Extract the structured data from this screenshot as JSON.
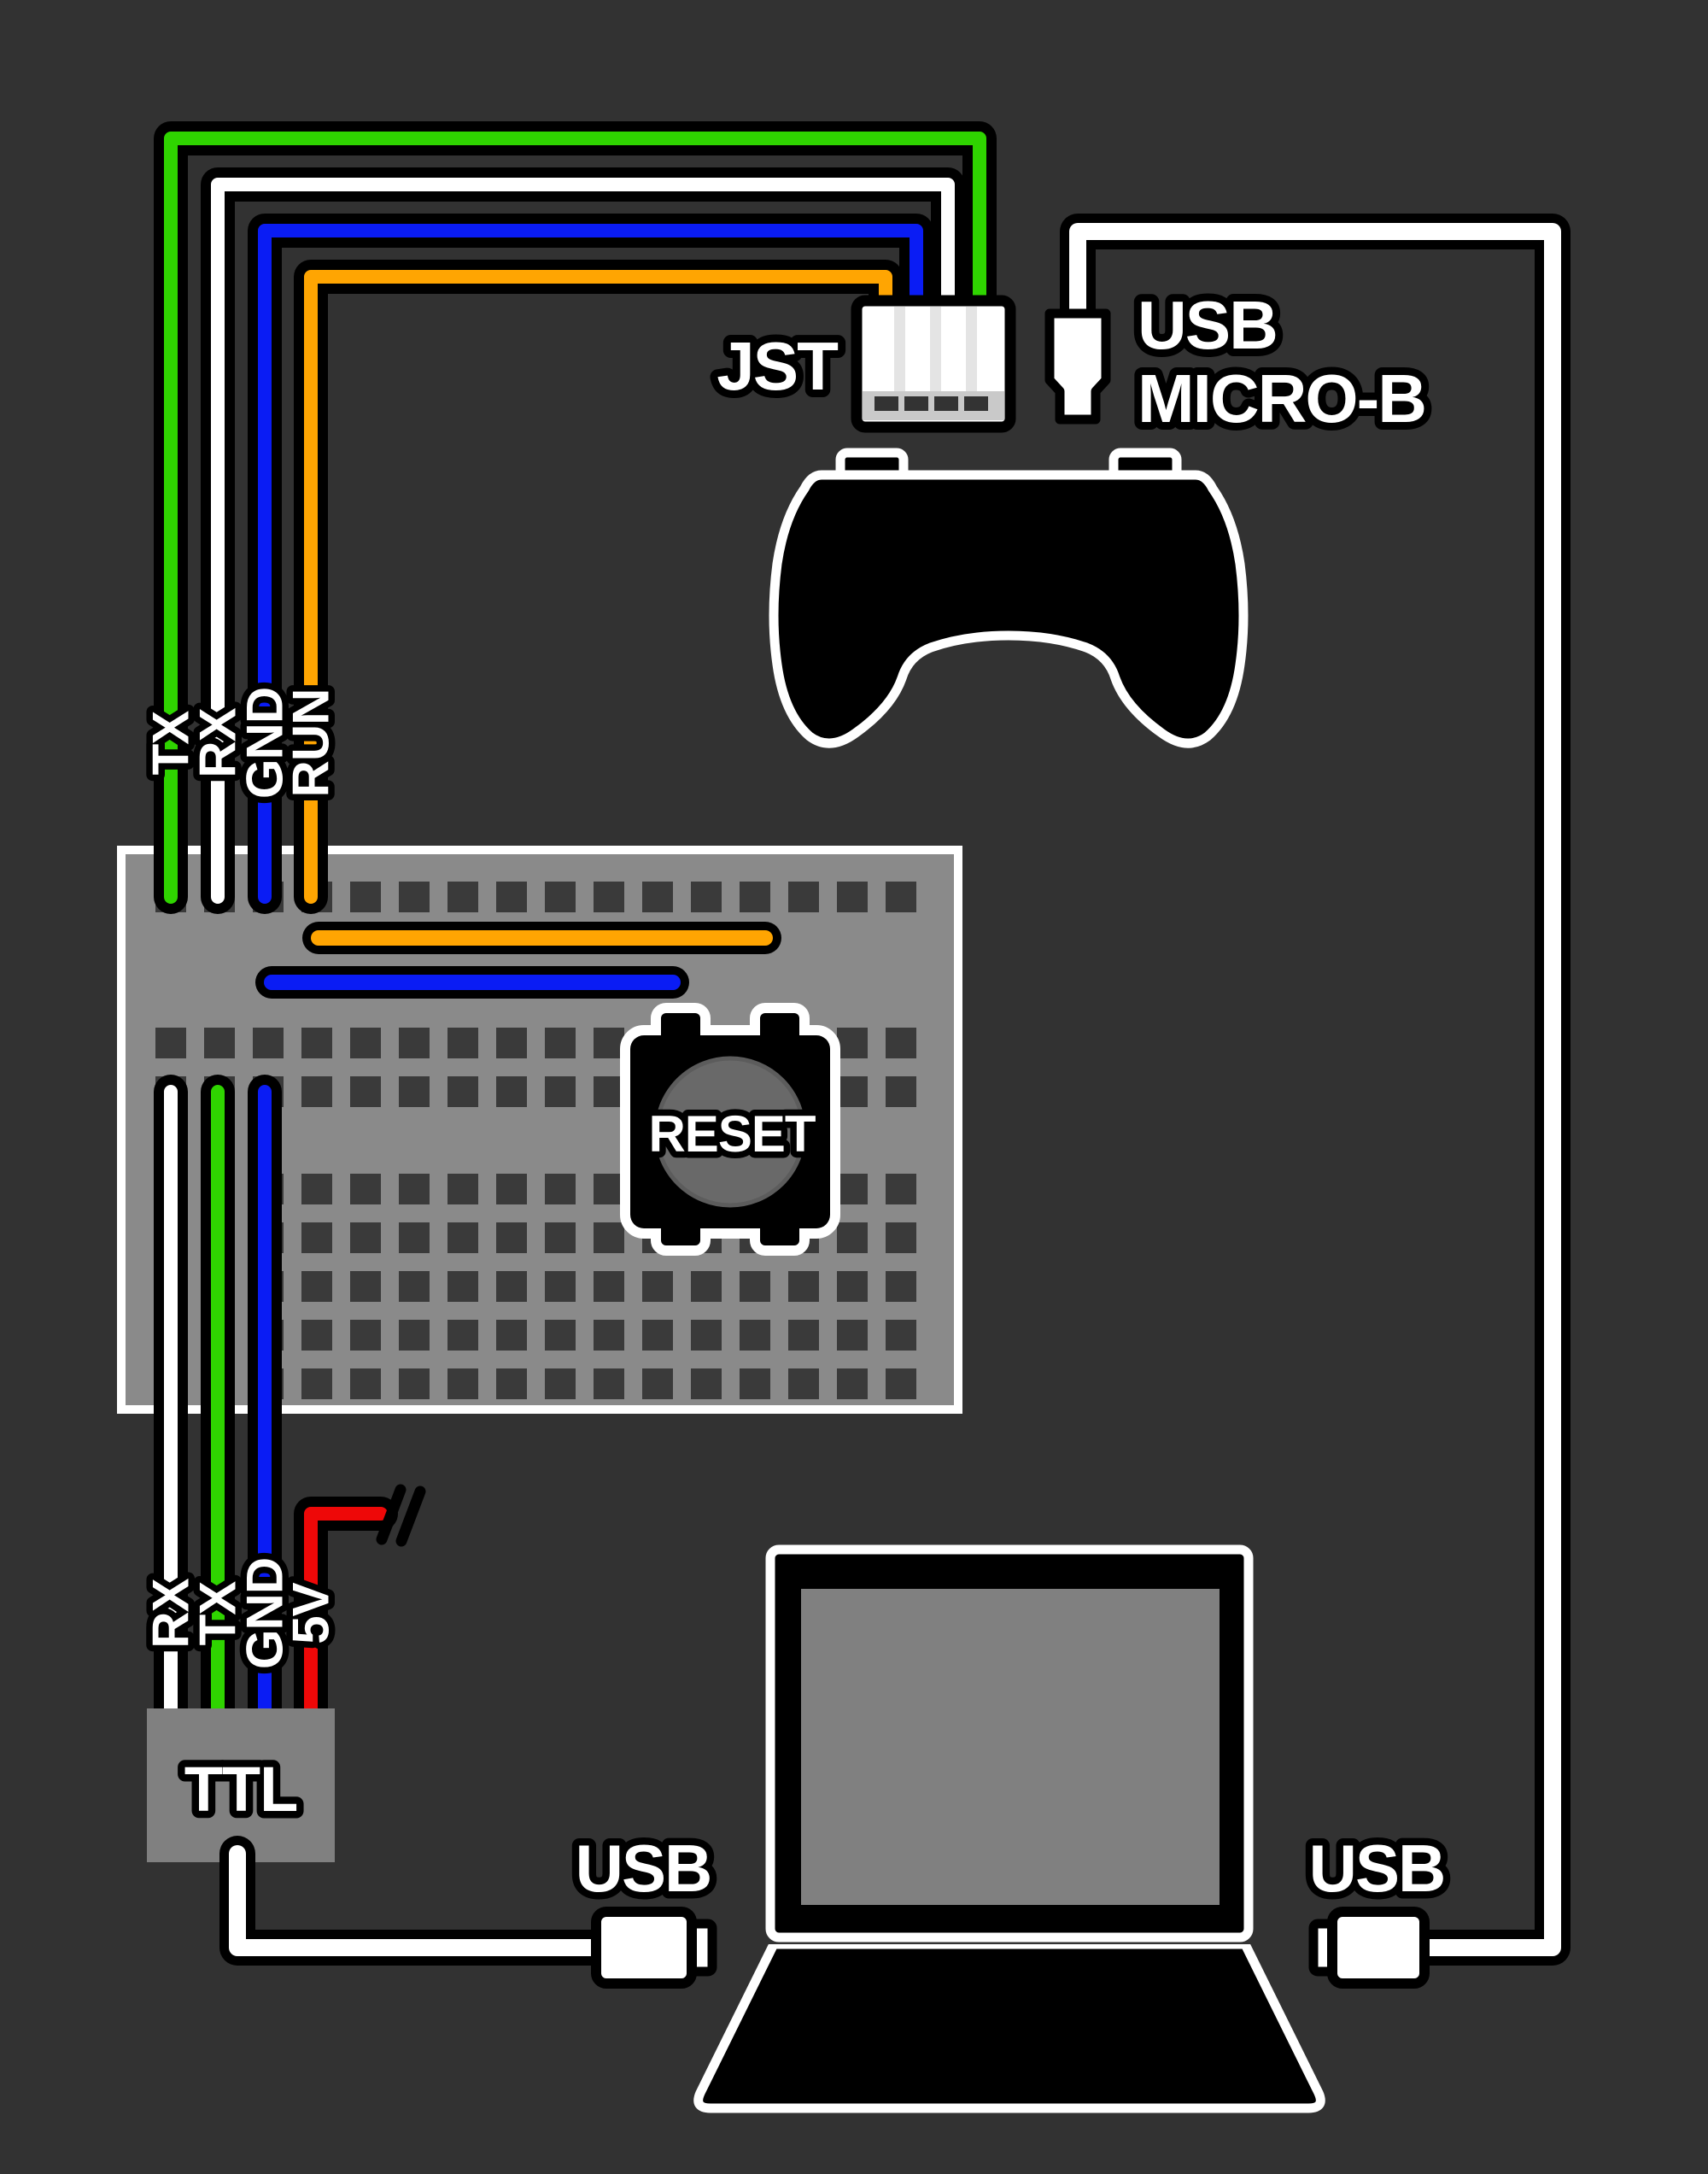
{
  "colors": {
    "background": "#323232",
    "outline": "#000000",
    "white": "#ffffff",
    "wire_green": "#2fd400",
    "wire_blue": "#0a1cf4",
    "wire_orange": "#ffa502",
    "wire_red": "#ee0808",
    "breadboard": "#8a8a8a",
    "hole": "#3a3a3a",
    "panel_gray": "#808080",
    "jst_stripe": "#e4e4e4",
    "jst_strip": "#c9c9c9",
    "jst_slot": "#333333",
    "reset_cap": "#696969"
  },
  "jst": {
    "label": "JST"
  },
  "usb_micro": {
    "line1": "USB",
    "line2": "MICRO-B"
  },
  "top_pins": [
    {
      "label": "TX",
      "wire": "green"
    },
    {
      "label": "RX",
      "wire": "white"
    },
    {
      "label": "GND",
      "wire": "blue"
    },
    {
      "label": "RUN",
      "wire": "orange"
    }
  ],
  "bottom_pins": [
    {
      "label": "RX",
      "wire": "white"
    },
    {
      "label": "TX",
      "wire": "green"
    },
    {
      "label": "GND",
      "wire": "blue"
    },
    {
      "label": "5V",
      "wire": "red"
    }
  ],
  "reset": {
    "label": "RESET"
  },
  "ttl": {
    "label": "TTL"
  },
  "usb_left": {
    "label": "USB"
  },
  "usb_right": {
    "label": "USB"
  }
}
